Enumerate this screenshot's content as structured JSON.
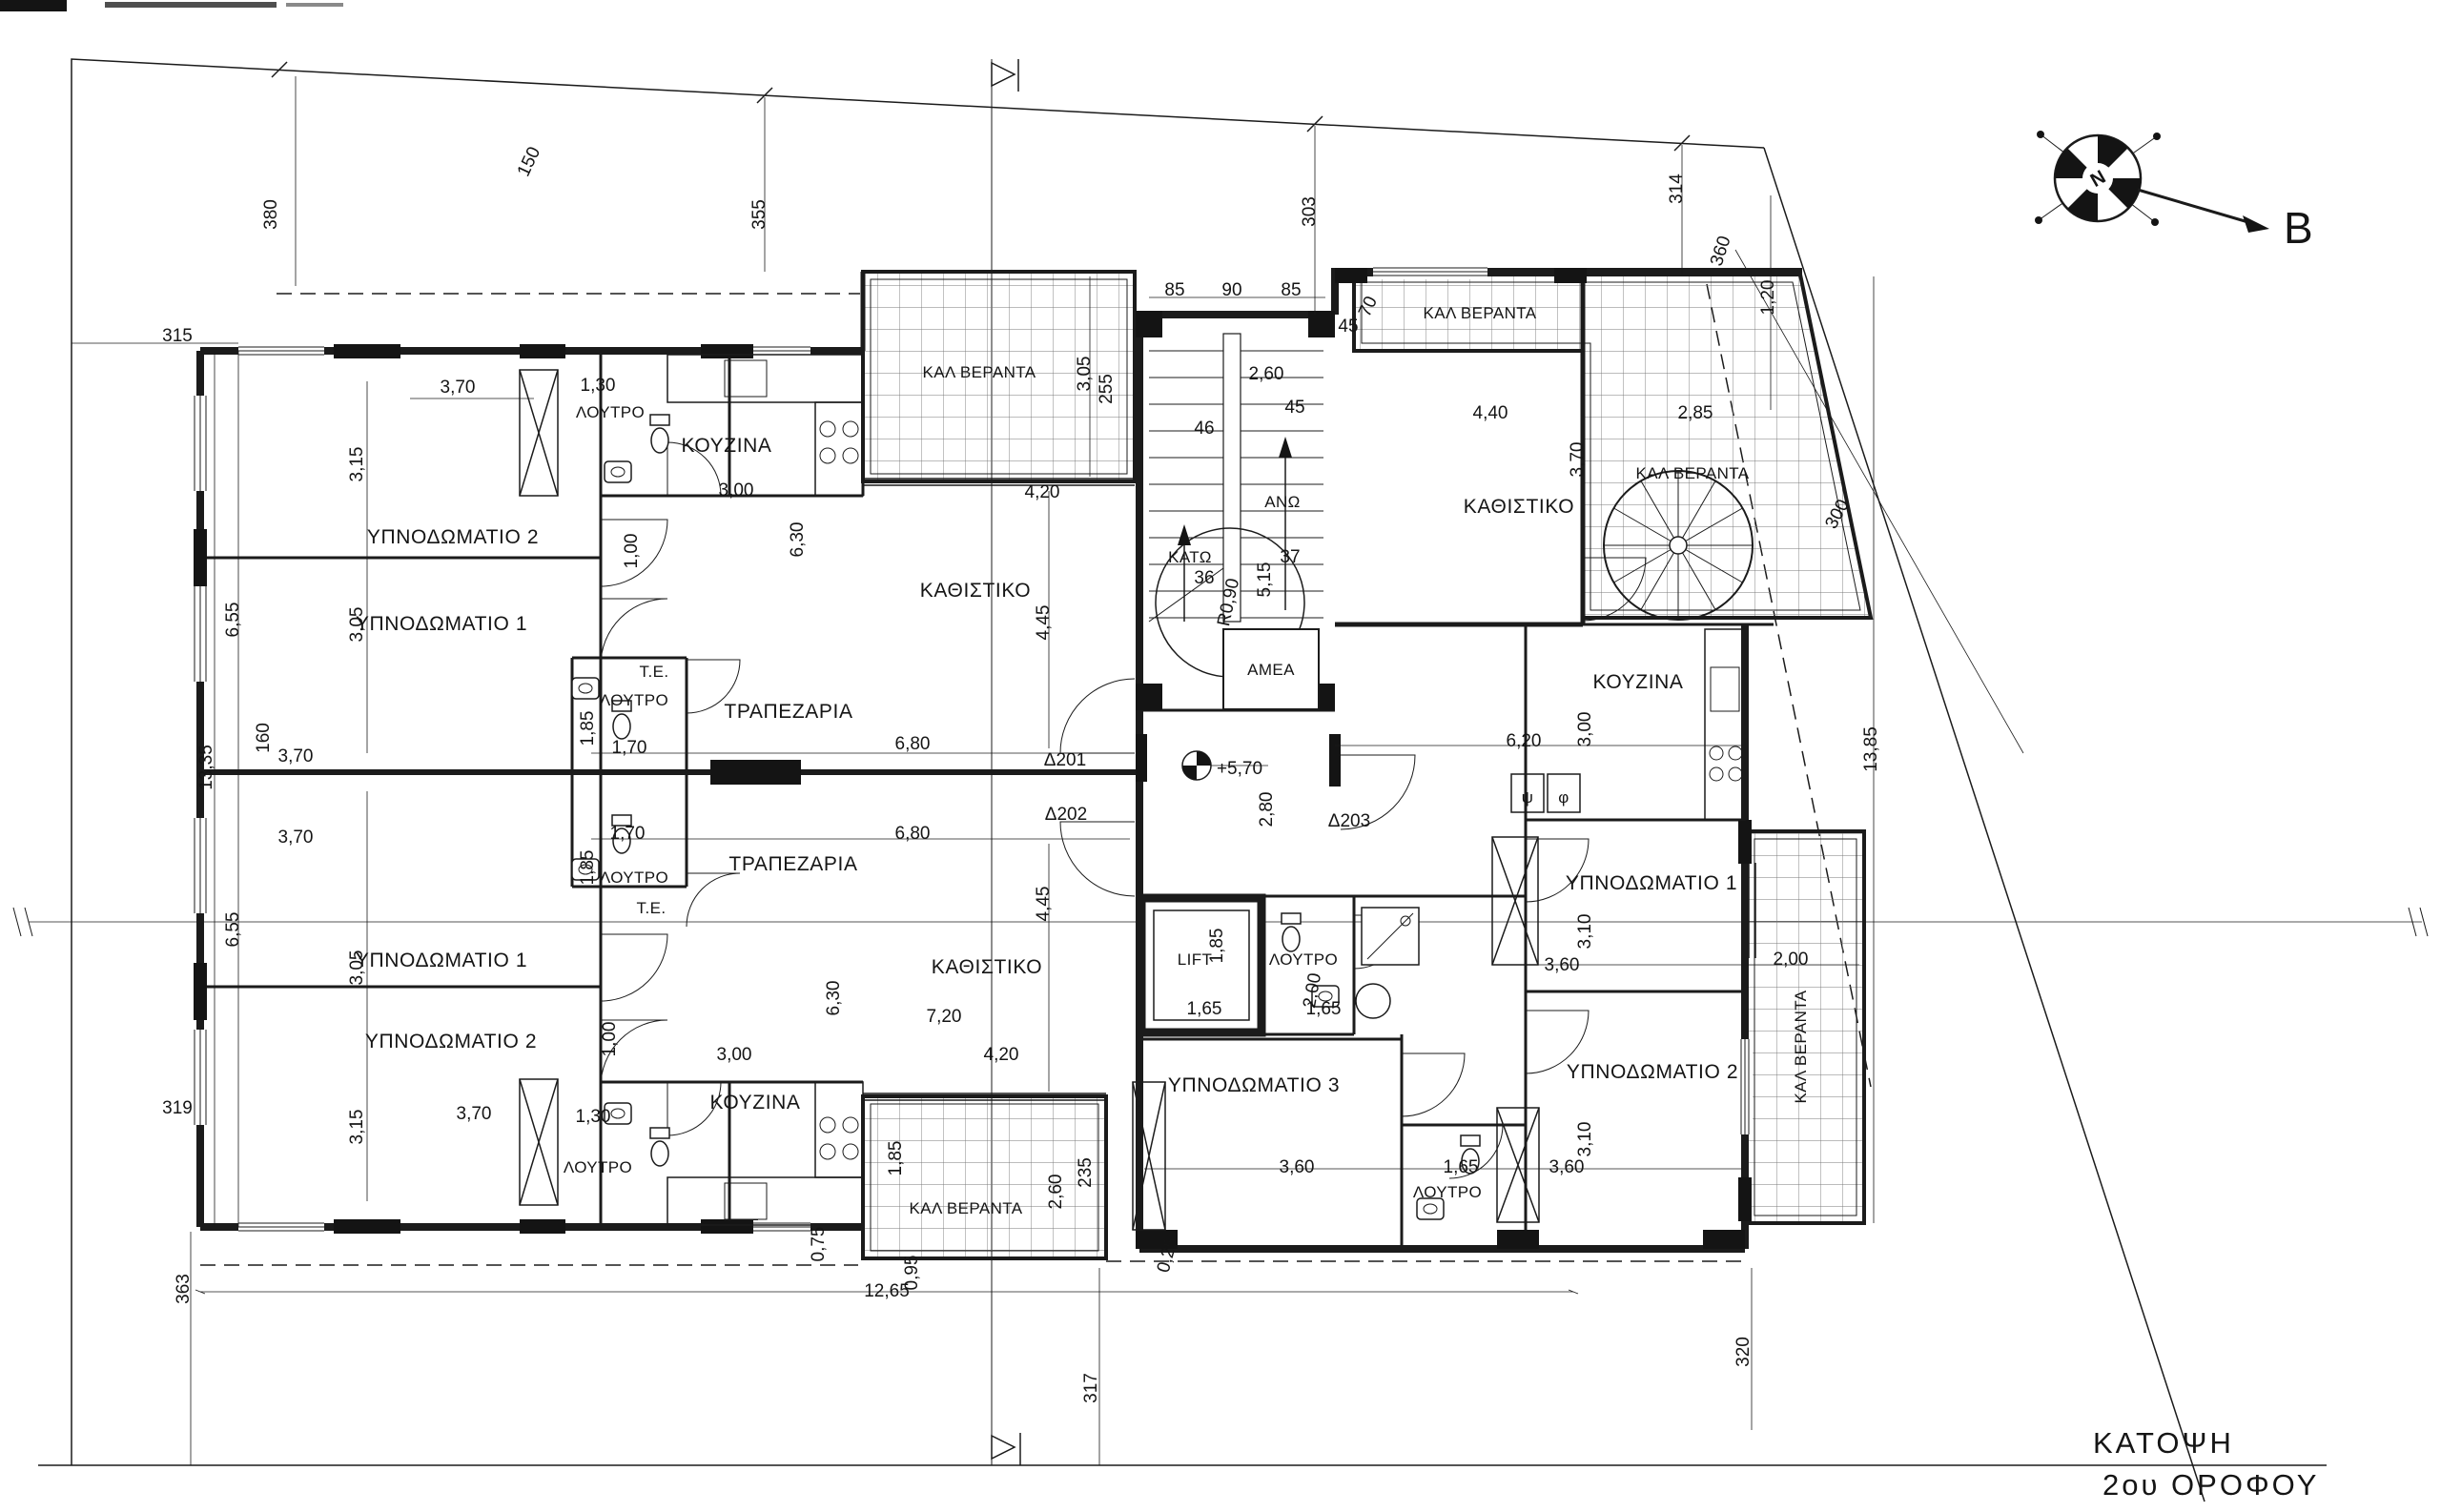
{
  "title": {
    "line1": "ΚΑΤΟΨΗ",
    "line2": "2ου ΟΡΟΦΟΥ"
  },
  "north": {
    "label": "B",
    "letter": "N"
  },
  "rooms": {
    "bed1": "ΥΠΝΟΔΩΜΑΤΙΟ 1",
    "bed2": "ΥΠΝΟΔΩΜΑΤΙΟ 2",
    "bed3": "ΥΠΝΟΔΩΜΑΤΙΟ 3",
    "bath": "ΛΟΥΤΡΟ",
    "kitchen": "ΚΟΥΖΙΝΑ",
    "dining": "ΤΡΑΠΕΖΑΡΙΑ",
    "living": "ΚΑΘΙΣΤΙΚΟ",
    "veranda": "ΚΑΛ ΒΕΡΑΝΤΑ",
    "lift": "LIFT",
    "amea": "ΑΜΕΑ",
    "te": "Τ.Ε.",
    "up": "ΑΝΩ",
    "down": "ΚΑΤΩ",
    "psi": "ψ",
    "phi": "φ"
  },
  "doors": {
    "d201": "Δ201",
    "d202": "Δ202",
    "d203": "Δ203"
  },
  "levels": {
    "floor": "+5,70"
  },
  "dims": {
    "n150": "150",
    "n380": "380",
    "n315": "315",
    "n355": "355",
    "n303": "303",
    "n314": "314",
    "n360": "360",
    "n319": "319",
    "n363": "363",
    "n317": "317",
    "n320": "320",
    "n160": "160",
    "n255": "255",
    "n235": "235",
    "n300": "300",
    "n85": "85",
    "n90": "90",
    "n45": "45",
    "n70": "70",
    "n46": "46",
    "n36": "36",
    "n37": "37",
    "v025": "0,25",
    "v075": "0,75",
    "v095": "0,95",
    "v100": "1,00",
    "v120": "1,20",
    "v130": "1,30",
    "v165": "1,65",
    "v170": "1,70",
    "v185": "1,85",
    "v200": "2,00",
    "v260": "2,60",
    "v280": "2,80",
    "v285": "2,85",
    "v300": "3,00",
    "v305": "3,05",
    "v310": "3,10",
    "v315": "3,15",
    "v360": "3,60",
    "v370": "3,70",
    "v420": "4,20",
    "v440": "4,40",
    "v445": "4,45",
    "v515": "5,15",
    "v620": "6,20",
    "v630": "6,30",
    "v655": "6,55",
    "v680": "6,80",
    "v720": "7,20",
    "v1265": "12,65",
    "v1335": "13,35",
    "v1385": "13,85",
    "r090": "R0,90"
  }
}
